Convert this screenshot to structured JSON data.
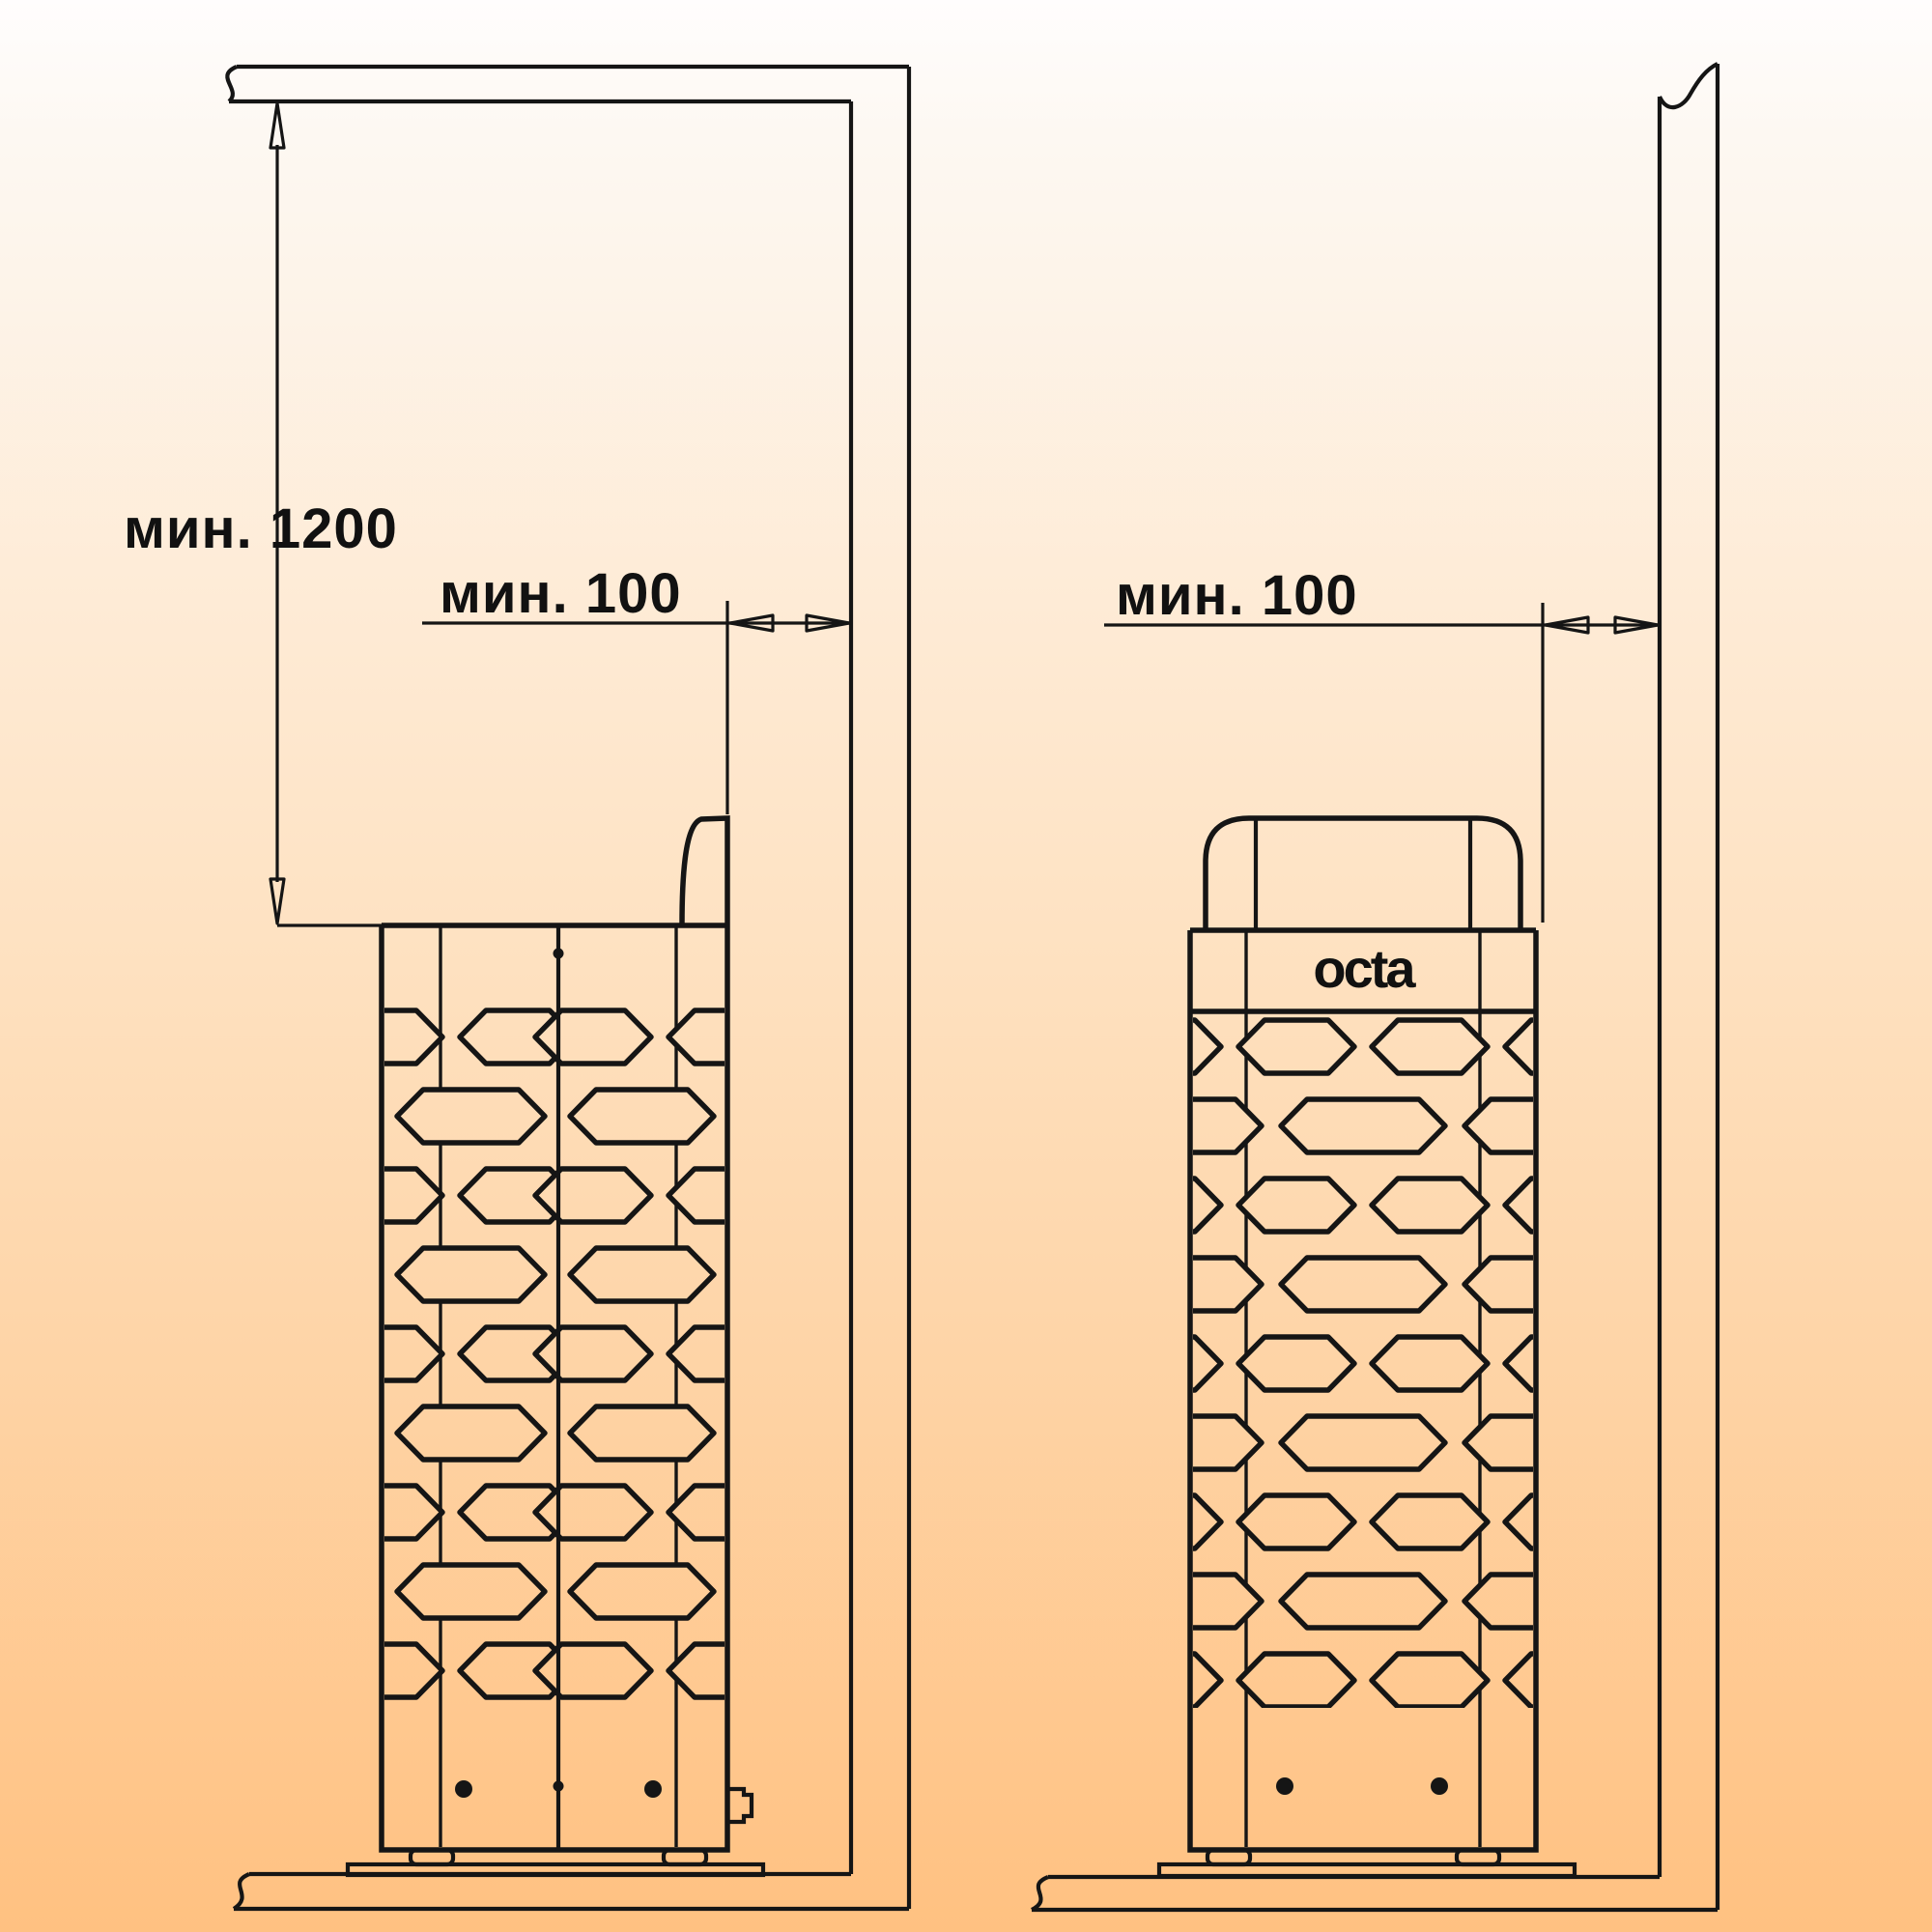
{
  "drawing": {
    "brand_logo": "octa",
    "line_color": "#151515",
    "background": {
      "top": "#fffdfd",
      "upper": "#fdf6ec",
      "middle": "#fee1c0",
      "bottom": "#ffc181"
    },
    "left_view": {
      "dim_vertical": "мин. 1200",
      "dim_horizontal": "мин. 100"
    },
    "right_view": {
      "dim_horizontal": "мин. 100"
    }
  }
}
